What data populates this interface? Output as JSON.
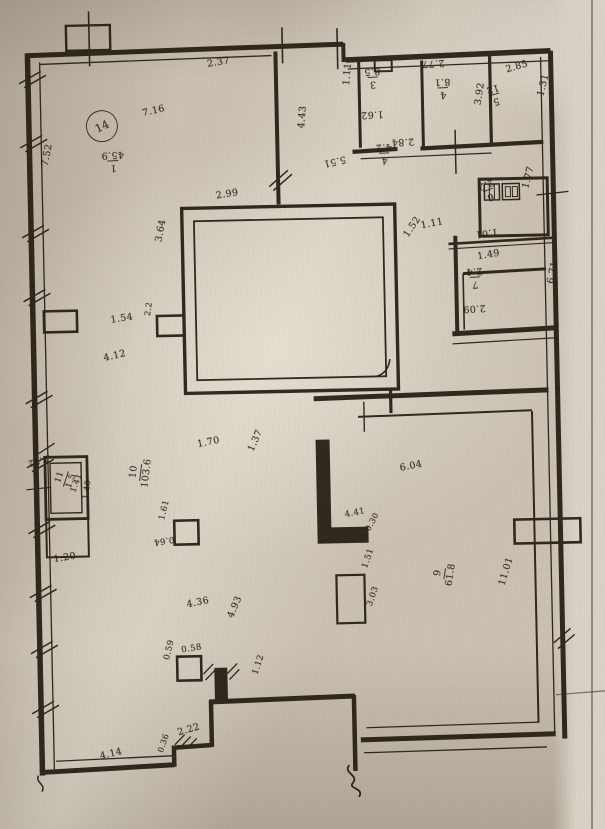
{
  "document_type": "scanned floor plan photograph",
  "colors": {
    "paper": "#c9c0b2",
    "ink": "#241c12",
    "paper_edge": "#d8d2c6"
  },
  "plan": {
    "unit_number": "14",
    "labels": [
      {
        "t": "2.37",
        "x": 214,
        "y": 58,
        "r": -8
      },
      {
        "t": "7.16",
        "x": 148,
        "y": 106,
        "r": -12
      },
      {
        "num": "1",
        "den": "45.9",
        "x": 130,
        "y": 168,
        "r": 178
      },
      {
        "t": "7.52",
        "x": 46,
        "y": 160,
        "r": -78
      },
      {
        "t": "4.43",
        "x": 303,
        "y": 128,
        "r": -84
      },
      {
        "t": "1.11",
        "x": 349,
        "y": 86,
        "r": -84
      },
      {
        "num": "3",
        "den": "8.5",
        "x": 388,
        "y": 90,
        "r": 178
      },
      {
        "t": "1.62",
        "x": 390,
        "y": 120,
        "r": 178
      },
      {
        "t": "2.77",
        "x": 452,
        "y": 70,
        "r": 178
      },
      {
        "num": "4",
        "den": "8.1",
        "x": 458,
        "y": 102,
        "r": 178
      },
      {
        "t": "2.85",
        "x": 512,
        "y": 70,
        "r": -15
      },
      {
        "num": "5",
        "den": "12",
        "x": 510,
        "y": 108,
        "r": 165
      },
      {
        "t": "3.92",
        "x": 480,
        "y": 108,
        "r": -80
      },
      {
        "t": "1.31",
        "x": 543,
        "y": 100,
        "r": -75
      },
      {
        "t": "2.84",
        "x": 420,
        "y": 148,
        "r": 178
      },
      {
        "t": "5.51",
        "x": 352,
        "y": 164,
        "r": 168
      },
      {
        "num": "4",
        "den": "4.2",
        "x": 398,
        "y": 166,
        "r": 178
      },
      {
        "t": "1.77",
        "x": 526,
        "y": 192,
        "r": -75
      },
      {
        "num": "6",
        "den": "2.2",
        "x": 504,
        "y": 202,
        "r": 160
      },
      {
        "t": "1.01",
        "x": 502,
        "y": 240,
        "r": 174
      },
      {
        "t": "1.11",
        "x": 424,
        "y": 224,
        "r": -10
      },
      {
        "t": "1.52",
        "x": 406,
        "y": 236,
        "r": -55
      },
      {
        "t": "1.49",
        "x": 480,
        "y": 256,
        "r": -8
      },
      {
        "num": "7",
        "den": "2.4",
        "x": 486,
        "y": 292,
        "r": 178
      },
      {
        "t": "2.09",
        "x": 488,
        "y": 316,
        "r": 178
      },
      {
        "t": "6.71",
        "x": 549,
        "y": 288,
        "r": -78
      },
      {
        "t": "2.99",
        "x": 220,
        "y": 190,
        "r": -8
      },
      {
        "t": "3.64",
        "x": 158,
        "y": 238,
        "r": -78
      },
      {
        "t": "1.54",
        "x": 112,
        "y": 312,
        "r": -8
      },
      {
        "t": "2.2",
        "x": 146,
        "y": 312,
        "r": -80,
        "fs": 8
      },
      {
        "t": "4.12",
        "x": 104,
        "y": 350,
        "r": -12
      },
      {
        "t": "1.70",
        "x": 196,
        "y": 438,
        "r": -10
      },
      {
        "t": "1.37",
        "x": 246,
        "y": 448,
        "r": -65
      },
      {
        "num": "10",
        "den": "103.6",
        "x": 126,
        "y": 482,
        "r": -82
      },
      {
        "t": "1.72",
        "x": 48,
        "y": 456,
        "r": 165,
        "fs": 8.5
      },
      {
        "num": "11",
        "den": "1.5",
        "x": 52,
        "y": 478,
        "r": -70,
        "fs": 8.5
      },
      {
        "t": "1.41",
        "x": 68,
        "y": 486,
        "r": -70,
        "fs": 8
      },
      {
        "t": "1.40",
        "x": 80,
        "y": 494,
        "r": -80,
        "fs": 8
      },
      {
        "t": "1.20",
        "x": 50,
        "y": 550,
        "r": -8
      },
      {
        "t": "1.61",
        "x": 156,
        "y": 516,
        "r": -75,
        "fs": 8.5
      },
      {
        "t": "0.64",
        "x": 172,
        "y": 540,
        "r": 172,
        "fs": 8.5
      },
      {
        "t": "6.04",
        "x": 398,
        "y": 466,
        "r": -10
      },
      {
        "num": "9",
        "den": "61.8",
        "x": 428,
        "y": 586,
        "r": -80
      },
      {
        "t": "11.01",
        "x": 494,
        "y": 588,
        "r": -72
      },
      {
        "t": "4.41",
        "x": 342,
        "y": 512,
        "r": -10,
        "fs": 8.5
      },
      {
        "t": "0.30",
        "x": 362,
        "y": 530,
        "r": -60,
        "fs": 8
      },
      {
        "t": "1.51",
        "x": 358,
        "y": 568,
        "r": -70,
        "fs": 8.5
      },
      {
        "t": "3.03",
        "x": 362,
        "y": 606,
        "r": -70,
        "fs": 8.5
      },
      {
        "t": "4.36",
        "x": 182,
        "y": 598,
        "r": -10
      },
      {
        "t": "4.93",
        "x": 222,
        "y": 614,
        "r": -65
      },
      {
        "t": "0.58",
        "x": 176,
        "y": 644,
        "r": -8,
        "fs": 8.5
      },
      {
        "t": "0.59",
        "x": 158,
        "y": 656,
        "r": -75,
        "fs": 8.5
      },
      {
        "t": "1.12",
        "x": 246,
        "y": 672,
        "r": -70,
        "fs": 8.5
      },
      {
        "t": "2.22",
        "x": 170,
        "y": 726,
        "r": -15
      },
      {
        "t": "0.36",
        "x": 150,
        "y": 748,
        "r": -70,
        "fs": 8
      },
      {
        "t": "4.14",
        "x": 92,
        "y": 748,
        "r": -12
      }
    ]
  }
}
